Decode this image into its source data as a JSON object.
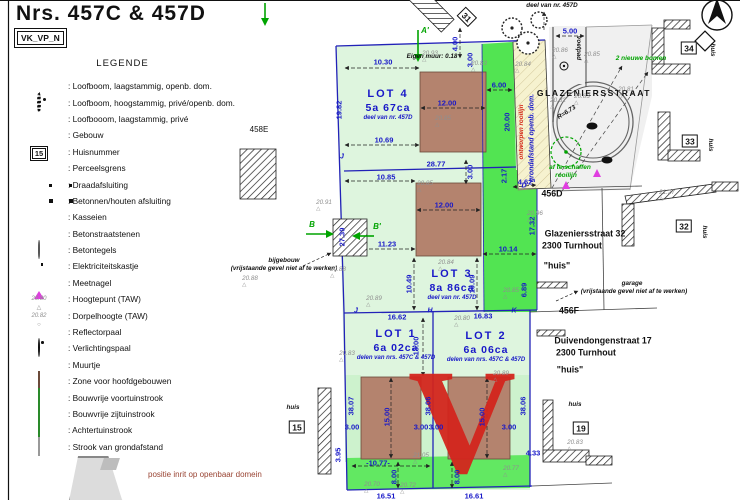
{
  "title": "Nrs. 457C & 457D",
  "ref_box": "VK_VP_N",
  "legend": {
    "heading": "LEGENDE",
    "items": [
      {
        "icon": "tree-small-public",
        "label": "Loofboom, laagstammig, openb. dom."
      },
      {
        "icon": "tree-tall",
        "label": "Loofboom, hoogstammig, privé/openb. dom."
      },
      {
        "icon": "tree-small-private",
        "label": "Loofbooom, laagstammig, privé"
      },
      {
        "icon": "building-hatch",
        "label": "Gebouw"
      },
      {
        "icon": "house-number",
        "label": "Huisnummer",
        "sample": "15"
      },
      {
        "icon": "parcel-line",
        "label": "Perceelsgrens"
      },
      {
        "icon": "wire-fence",
        "label": "Draadafsluiting"
      },
      {
        "icon": "concrete-fence",
        "label": "Betonnen/houten afsluiting"
      },
      {
        "icon": "cobbles",
        "label": "Kasseien"
      },
      {
        "icon": "concrete-pavers",
        "label": "Betonstraatstenen"
      },
      {
        "icon": "concrete-tiles",
        "label": "Betontegels"
      },
      {
        "icon": "electric-cabinet",
        "label": "Elektriciteitskastje"
      },
      {
        "icon": "survey-nail",
        "label": "Meetnagel"
      },
      {
        "icon": "height-point",
        "label": "Hoogtepunt (TAW)",
        "sample": "20.80"
      },
      {
        "icon": "sill-height",
        "label": "Dorpelhoogte (TAW)",
        "sample": "20.82"
      },
      {
        "icon": "reflector-post",
        "label": "Reflectorpaal"
      },
      {
        "icon": "light-post",
        "label": "Verlichtingspaal"
      },
      {
        "icon": "small-wall",
        "label": "Muurtje"
      },
      {
        "icon": "zone-brown",
        "label": "Zone voor hoofdgebouwen"
      },
      {
        "icon": "zone-green",
        "label": "Bouwvrije voortuinstrook"
      },
      {
        "icon": "zone-lightgreen",
        "label": "Bouwvrije zijtuinstrook"
      },
      {
        "icon": "zone-green2",
        "label": "Achtertuinstrook"
      },
      {
        "icon": "zone-yellow",
        "label": "Strook van grondafstand"
      }
    ],
    "footnote": "positie inrit op openbaar domein"
  },
  "plan": {
    "lots": [
      {
        "id": "LOT 4",
        "area": "5a 67ca",
        "note": "deel van nr. 457D",
        "x": 388,
        "y": 105
      },
      {
        "id": "LOT 3",
        "area": "8a 86ca",
        "note": "deel van nr. 457D",
        "x": 452,
        "y": 285
      },
      {
        "id": "LOT 1",
        "area": "6a 02ca",
        "note": "delen van nrs. 457C & 457D",
        "x": 396,
        "y": 345
      },
      {
        "id": "LOT 2",
        "area": "6a 06ca",
        "note": "delen van nrs. 457C & 457D",
        "x": 486,
        "y": 347
      }
    ],
    "house_numbers": [
      {
        "n": "31",
        "x": 467,
        "y": 17,
        "rot": 45
      },
      {
        "n": "34",
        "x": 689,
        "y": 48
      },
      {
        "n": "33",
        "x": 690,
        "y": 141
      },
      {
        "n": "32",
        "x": 684,
        "y": 226
      },
      {
        "n": "15",
        "x": 297,
        "y": 427
      },
      {
        "n": "19",
        "x": 581,
        "y": 428
      }
    ],
    "measurements": [
      {
        "t": "10.30",
        "x": 383,
        "y": 62
      },
      {
        "t": "12.00",
        "x": 447,
        "y": 103
      },
      {
        "t": "6.00",
        "x": 499,
        "y": 85
      },
      {
        "t": "10.69",
        "x": 384,
        "y": 140
      },
      {
        "t": "28.77",
        "x": 436,
        "y": 164
      },
      {
        "t": "10.85",
        "x": 386,
        "y": 177
      },
      {
        "t": "3.00",
        "x": 470,
        "y": 172,
        "rot": -90
      },
      {
        "t": "3.00",
        "x": 470,
        "y": 60,
        "rot": -90
      },
      {
        "t": "12.00",
        "x": 444,
        "y": 205
      },
      {
        "t": "11.23",
        "x": 387,
        "y": 244
      },
      {
        "t": "10.49",
        "x": 409,
        "y": 284,
        "rot": -90
      },
      {
        "t": "10.09",
        "x": 472,
        "y": 284,
        "rot": -90
      },
      {
        "t": "10.14",
        "x": 508,
        "y": 249
      },
      {
        "t": "20.00",
        "x": 507,
        "y": 122,
        "rot": -90
      },
      {
        "t": "19.82",
        "x": 339,
        "y": 110,
        "rot": -90
      },
      {
        "t": "27.39",
        "x": 342,
        "y": 237,
        "rot": -90
      },
      {
        "t": "2.17",
        "x": 504,
        "y": 176,
        "rot": -90
      },
      {
        "t": "4.62",
        "x": 525,
        "y": 182
      },
      {
        "t": "17.32",
        "x": 532,
        "y": 226,
        "rot": -90
      },
      {
        "t": "6.89",
        "x": 524,
        "y": 290,
        "rot": -90
      },
      {
        "t": "16.62",
        "x": 397,
        "y": 317
      },
      {
        "t": "16.83",
        "x": 483,
        "y": 316
      },
      {
        "t": "13.00",
        "x": 416,
        "y": 346,
        "rot": -90
      },
      {
        "t": "15.00",
        "x": 387,
        "y": 417,
        "rot": -90
      },
      {
        "t": "15.00",
        "x": 482,
        "y": 417,
        "rot": -90
      },
      {
        "t": "38.07",
        "x": 351,
        "y": 406,
        "rot": -90
      },
      {
        "t": "38.06",
        "x": 428,
        "y": 406,
        "rot": -90
      },
      {
        "t": "38.06",
        "x": 523,
        "y": 406,
        "rot": -90
      },
      {
        "t": "3.00",
        "x": 352,
        "y": 427
      },
      {
        "t": "3.00",
        "x": 421,
        "y": 427
      },
      {
        "t": "3.00",
        "x": 436,
        "y": 427
      },
      {
        "t": "3.00",
        "x": 509,
        "y": 427
      },
      {
        "t": "-10.77-",
        "x": 378,
        "y": 463
      },
      {
        "t": "8.00",
        "x": 394,
        "y": 477,
        "rot": -90
      },
      {
        "t": "8.00",
        "x": 457,
        "y": 477,
        "rot": -90
      },
      {
        "t": "3.95",
        "x": 338,
        "y": 455,
        "rot": -90
      },
      {
        "t": "4.33",
        "x": 533,
        "y": 453
      },
      {
        "t": "5.00",
        "x": 570,
        "y": 31
      },
      {
        "t": "4.00",
        "x": 455,
        "y": 44,
        "rot": -90
      },
      {
        "t": "16.51",
        "x": 386,
        "y": 496
      },
      {
        "t": "16.61",
        "x": 474,
        "y": 496
      }
    ],
    "height_points": [
      {
        "v": "20.93",
        "x": 430,
        "y": 57
      },
      {
        "v": "20.83",
        "x": 479,
        "y": 67
      },
      {
        "v": "20.84",
        "x": 523,
        "y": 68
      },
      {
        "v": "20.85",
        "x": 443,
        "y": 122
      },
      {
        "v": "20.86",
        "x": 560,
        "y": 54
      },
      {
        "v": "20.85",
        "x": 592,
        "y": 58
      },
      {
        "v": "20.82",
        "x": 558,
        "y": 104
      },
      {
        "v": "20.83",
        "x": 582,
        "y": 100
      },
      {
        "v": "20.81",
        "x": 626,
        "y": 93
      },
      {
        "v": "20.91",
        "x": 324,
        "y": 206
      },
      {
        "v": "20.88",
        "x": 338,
        "y": 273
      },
      {
        "v": "20.88",
        "x": 250,
        "y": 282
      },
      {
        "v": "20.85",
        "x": 425,
        "y": 187
      },
      {
        "v": "20.96",
        "x": 535,
        "y": 217
      },
      {
        "v": "20.84",
        "x": 446,
        "y": 266
      },
      {
        "v": "20.89",
        "x": 374,
        "y": 302
      },
      {
        "v": "20.85",
        "x": 511,
        "y": 294
      },
      {
        "v": "20.80",
        "x": 462,
        "y": 322
      },
      {
        "v": "20.83",
        "x": 347,
        "y": 357
      },
      {
        "v": "20.89",
        "x": 501,
        "y": 377
      },
      {
        "v": "21.05",
        "x": 421,
        "y": 459
      },
      {
        "v": "20.70",
        "x": 372,
        "y": 488
      },
      {
        "v": "20.72",
        "x": 408,
        "y": 489
      },
      {
        "v": "20.77",
        "x": 511,
        "y": 472
      },
      {
        "v": "20.83",
        "x": 575,
        "y": 446
      },
      {
        "v": "21.27",
        "x": 667,
        "y": 196
      }
    ],
    "texts": [
      {
        "t": "GLAZENIERSSTRAAT",
        "x": 594,
        "y": 93,
        "cls": "kb"
      },
      {
        "t": "R=6.73",
        "x": 567,
        "y": 113,
        "cls": "ki",
        "rot": -33
      },
      {
        "t": "456D",
        "x": 552,
        "y": 194,
        "cls": "adr"
      },
      {
        "t": "Glazeniersstraat 32",
        "x": 585,
        "y": 234,
        "cls": "adr"
      },
      {
        "t": "2300 Turnhout",
        "x": 572,
        "y": 246,
        "cls": "adr"
      },
      {
        "t": "\"huis\"",
        "x": 557,
        "y": 266,
        "cls": "adr"
      },
      {
        "t": "456F",
        "x": 569,
        "y": 311,
        "cls": "adr"
      },
      {
        "t": "Duivendongenstraat 17",
        "x": 603,
        "y": 341,
        "cls": "adr"
      },
      {
        "t": "2300 Turnhout",
        "x": 586,
        "y": 353,
        "cls": "adr"
      },
      {
        "t": "\"huis\"",
        "x": 570,
        "y": 370,
        "cls": "adr"
      },
      {
        "t": "garage",
        "x": 632,
        "y": 284,
        "cls": "ki"
      },
      {
        "t": "(vrijstaande gevel niet af te werken)",
        "x": 634,
        "y": 292,
        "cls": "ki"
      },
      {
        "t": "bijgebouw",
        "x": 284,
        "y": 261,
        "cls": "ki"
      },
      {
        "t": "(vrijstaande gevel niet af te werken)",
        "x": 284,
        "y": 269,
        "cls": "ki"
      },
      {
        "t": "deel van nr. 457D",
        "x": 552,
        "y": 6,
        "cls": "ki"
      },
      {
        "t": "Eigen muur: 0.18",
        "x": 432,
        "y": 57,
        "cls": "ki"
      },
      {
        "t": "huis",
        "x": 712,
        "y": 50,
        "cls": "ki",
        "rot": 90
      },
      {
        "t": "huis",
        "x": 710,
        "y": 145,
        "cls": "ki",
        "rot": 90
      },
      {
        "t": "huis",
        "x": 704,
        "y": 232,
        "cls": "ki",
        "rot": 90
      },
      {
        "t": "huis",
        "x": 575,
        "y": 405,
        "cls": "ki"
      },
      {
        "t": "huis",
        "x": 293,
        "y": 408,
        "cls": "ki"
      },
      {
        "t": "voetpad",
        "x": 578,
        "y": 48,
        "cls": "ki",
        "rot": 90
      },
      {
        "t": "af te schaffen",
        "x": 570,
        "y": 168,
        "cls": "gn"
      },
      {
        "t": "rooilijn",
        "x": 566,
        "y": 176,
        "cls": "gn"
      },
      {
        "t": "2 nieuwe bomen",
        "x": 641,
        "y": 59,
        "cls": "gn"
      },
      {
        "t": "ontworpen rooilijn",
        "x": 522,
        "y": 132,
        "cls": "rd",
        "rot": -90
      },
      {
        "t": "grondafstand openb. dom.",
        "x": 532,
        "y": 138,
        "cls": "mi",
        "rot": -90
      },
      {
        "t": "458E",
        "x": 259,
        "y": 130,
        "cls": "k"
      }
    ],
    "letters": [
      {
        "t": "A'",
        "x": 425,
        "y": 31,
        "cls": "gl"
      },
      {
        "t": "B",
        "x": 312,
        "y": 225,
        "cls": "gl"
      },
      {
        "t": "B'",
        "x": 377,
        "y": 227,
        "cls": "gl"
      },
      {
        "t": "J",
        "x": 342,
        "y": 157,
        "cls": "mi"
      },
      {
        "t": "J",
        "x": 356,
        "y": 311,
        "cls": "mi"
      },
      {
        "t": "H",
        "x": 430,
        "y": 311,
        "cls": "mi"
      },
      {
        "t": "K",
        "x": 514,
        "y": 311,
        "cls": "mi"
      },
      {
        "t": "D",
        "x": 524,
        "y": 186,
        "cls": "mi"
      }
    ],
    "watermark": "V",
    "colors": {
      "pale_green": "#def5de",
      "side_green": "#cdf2cd",
      "bright_green": "#52e452",
      "bottom_green": "#62e862",
      "zone_brown": "#b4836e",
      "strip_yellow": "#f6f2cf",
      "street_gray": "#f0f0f0",
      "measure_blue": "#1818c8",
      "accent_green": "#00a400",
      "survey_magenta": "#e03ee0",
      "watermark_red": "#d3251c"
    }
  }
}
